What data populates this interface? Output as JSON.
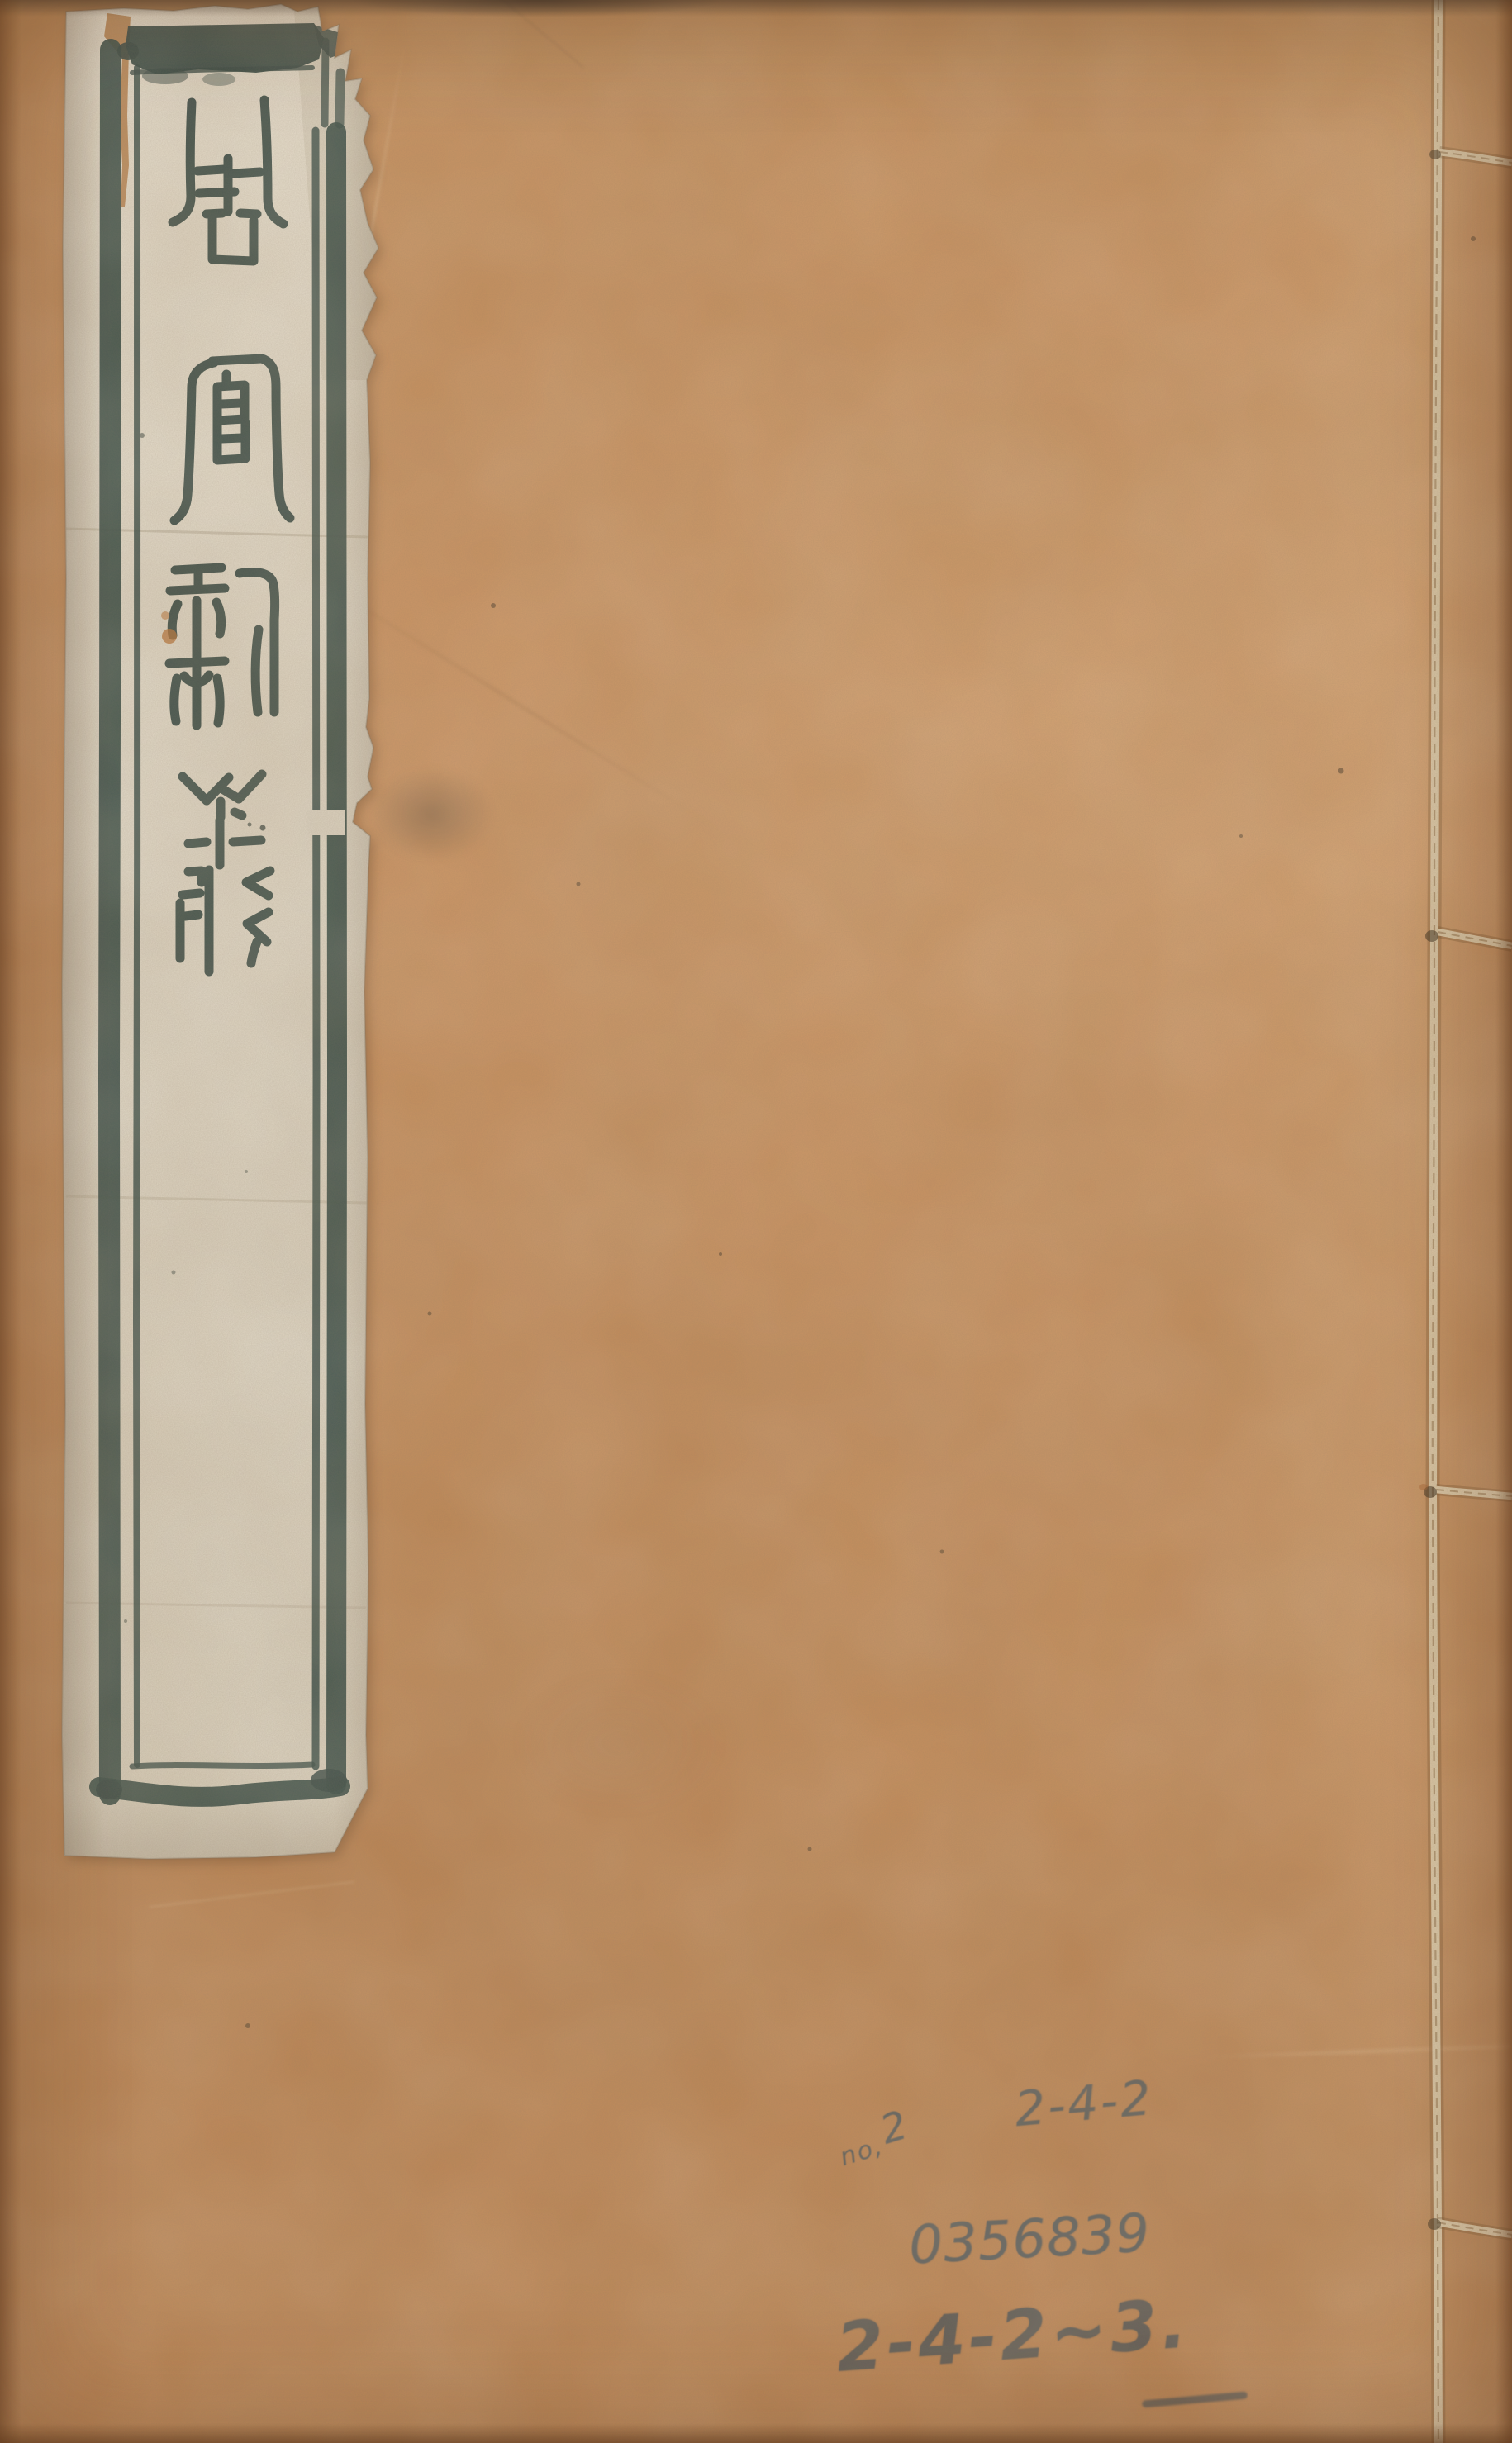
{
  "cover": {
    "title_label": {
      "text": "周官新義",
      "characters": [
        "周",
        "官",
        "新",
        "義"
      ]
    },
    "annotations": {
      "note": {
        "prefix": "no,",
        "number": "2"
      },
      "call_number_top": "2-4-2",
      "serial_number": "0356839",
      "call_number_bottom": "2-4-2~3."
    },
    "colors": {
      "cover_paper": "#c68e5b",
      "label_paper": "#e6decd",
      "ink": "#2b403c",
      "pencil": "#4b565c",
      "binding_thread": "#dcc9a7"
    }
  }
}
